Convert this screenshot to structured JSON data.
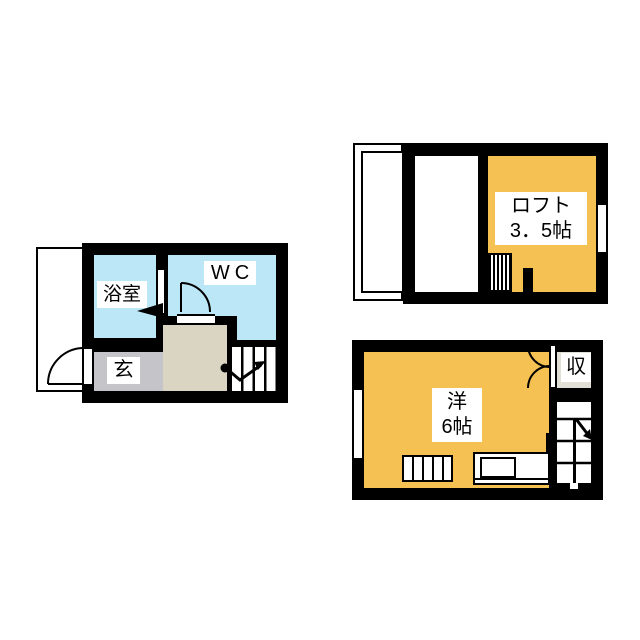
{
  "plan_type": "japanese-apartment-floorplan",
  "floor1": {
    "bathroom_label": "浴室",
    "wc_label": "WC",
    "entrance_label": "玄"
  },
  "loft": {
    "name_line": "ロフト",
    "size_line": "3．5帖"
  },
  "floor2": {
    "room_name_line": "洋",
    "room_size_line": "6帖",
    "closet_label": "収"
  },
  "colors": {
    "wet_area_blue": "#BCE7F7",
    "room_orange": "#F5C152",
    "entrance_gray": "#C4C4C9",
    "hallway_beige": "#D9D5C2",
    "closet_gray": "#E2E0D6",
    "wall_black": "#000000",
    "background": "#FFFFFF"
  }
}
